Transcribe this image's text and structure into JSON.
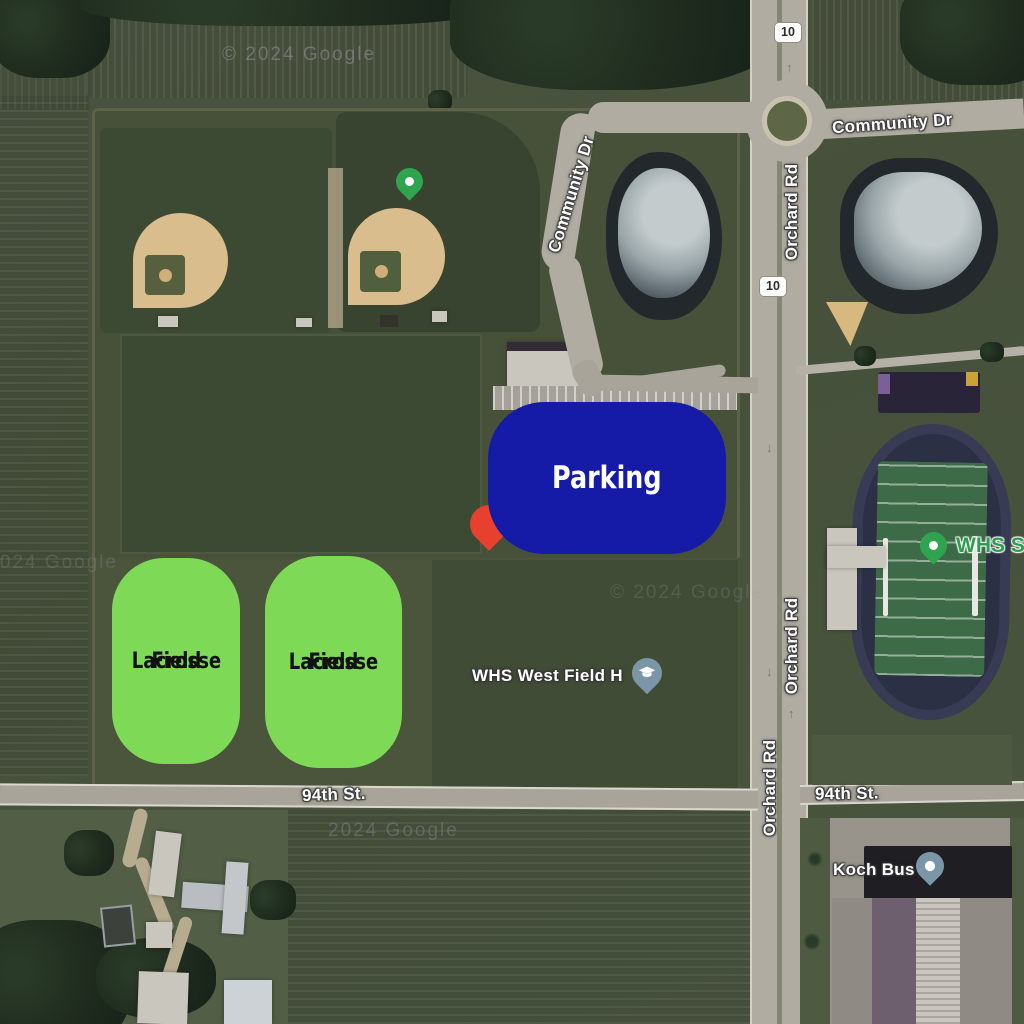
{
  "attribution": {
    "full": "© 2024 Google",
    "short": "2024 Google"
  },
  "roads": {
    "community_dr_curve": "Community Dr",
    "community_dr_top": "Community Dr",
    "orchard_rd_top": "Orchard Rd",
    "orchard_rd_mid": "Orchard Rd",
    "orchard_rd_bottom": "Orchard Rd",
    "st94_west": "94th St.",
    "st94_east": "94th St.",
    "route_shield": "10"
  },
  "pois": {
    "whs_west_field": "WHS West Field H",
    "whs_stadium": "WHS Sta",
    "koch_bus": "Koch Bus"
  },
  "annotations": {
    "parking": {
      "label": "Parking",
      "fill": "#151ba6",
      "text_color": "#ffffff"
    },
    "lacrosse_field_1": {
      "line1": "Lacrosse",
      "line2": "Field"
    },
    "lacrosse_field_2": {
      "line1": "Lacrosse",
      "line2": "Field"
    },
    "lacrosse_fill": "#7ed957",
    "lacrosse_text_color": "#111111",
    "red_pin_color": "#e8402f"
  },
  "icons": {
    "map_pin_green": "#2fa44f",
    "school_pin": "#7b96a8",
    "generic_pin": "#7b96a8"
  }
}
